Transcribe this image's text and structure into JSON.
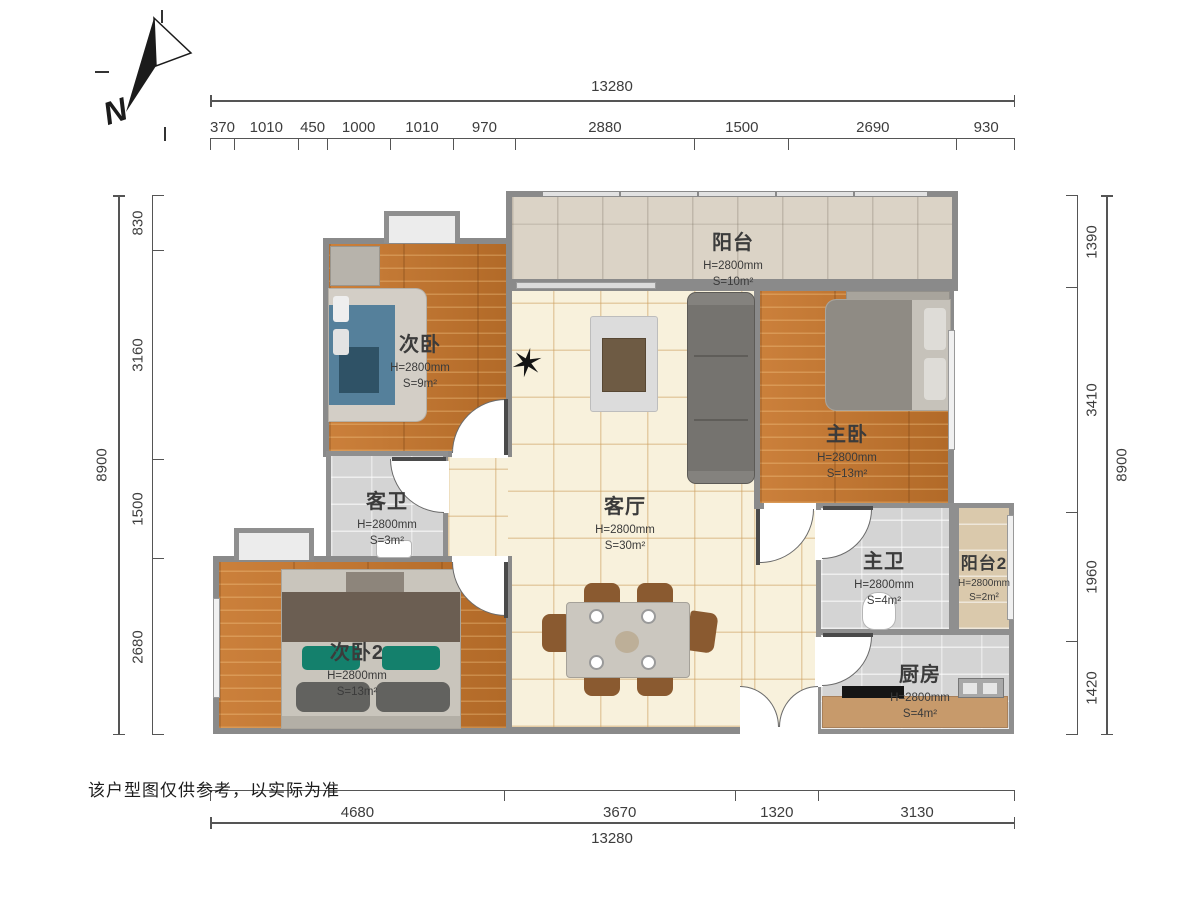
{
  "north_label": "N",
  "disclaimer": "该户型图仅供参考，以实际为准",
  "dimensions": {
    "top": {
      "total": "13280",
      "segments": [
        "370",
        "1010",
        "450",
        "1000",
        "1010",
        "970",
        "2880",
        "1500",
        "2690",
        "930"
      ]
    },
    "bottom": {
      "total": "13280",
      "segments": [
        "4680",
        "3670",
        "1320",
        "3130"
      ]
    },
    "left": {
      "total": "8900",
      "segments": [
        "830",
        "3160",
        "1500",
        "2680"
      ]
    },
    "right": {
      "total": "8900",
      "segments": [
        "1390",
        "3410",
        "1960",
        "1420"
      ]
    }
  },
  "rooms": [
    {
      "name": "阳台",
      "height": "H=2800mm",
      "area": "S=10m²"
    },
    {
      "name": "次卧",
      "height": "H=2800mm",
      "area": "S=9m²"
    },
    {
      "name": "主卧",
      "height": "H=2800mm",
      "area": "S=13m²"
    },
    {
      "name": "客卫",
      "height": "H=2800mm",
      "area": "S=3m²"
    },
    {
      "name": "客厅",
      "height": "H=2800mm",
      "area": "S=30m²"
    },
    {
      "name": "主卫",
      "height": "H=2800mm",
      "area": "S=4m²"
    },
    {
      "name": "阳台2",
      "height": "H=2800mm",
      "area": "S=2m²"
    },
    {
      "name": "次卧2",
      "height": "H=2800mm",
      "area": "S=13m²"
    },
    {
      "name": "厨房",
      "height": "H=2800mm",
      "area": "S=4m²"
    }
  ],
  "colors": {
    "wall": "#8a8a8a",
    "wood_floor": "#c57a35",
    "tile_cream": "#f8f1dc",
    "tile_gray": "#d4d4d4",
    "balcony_tile": "#dbd3c6",
    "balcony2_tile": "#dac9ac",
    "counter": "#c79a6b",
    "pillow_green": "#14806c",
    "bed_blue": "#55809b",
    "dim_text": "#3d3d3d"
  }
}
